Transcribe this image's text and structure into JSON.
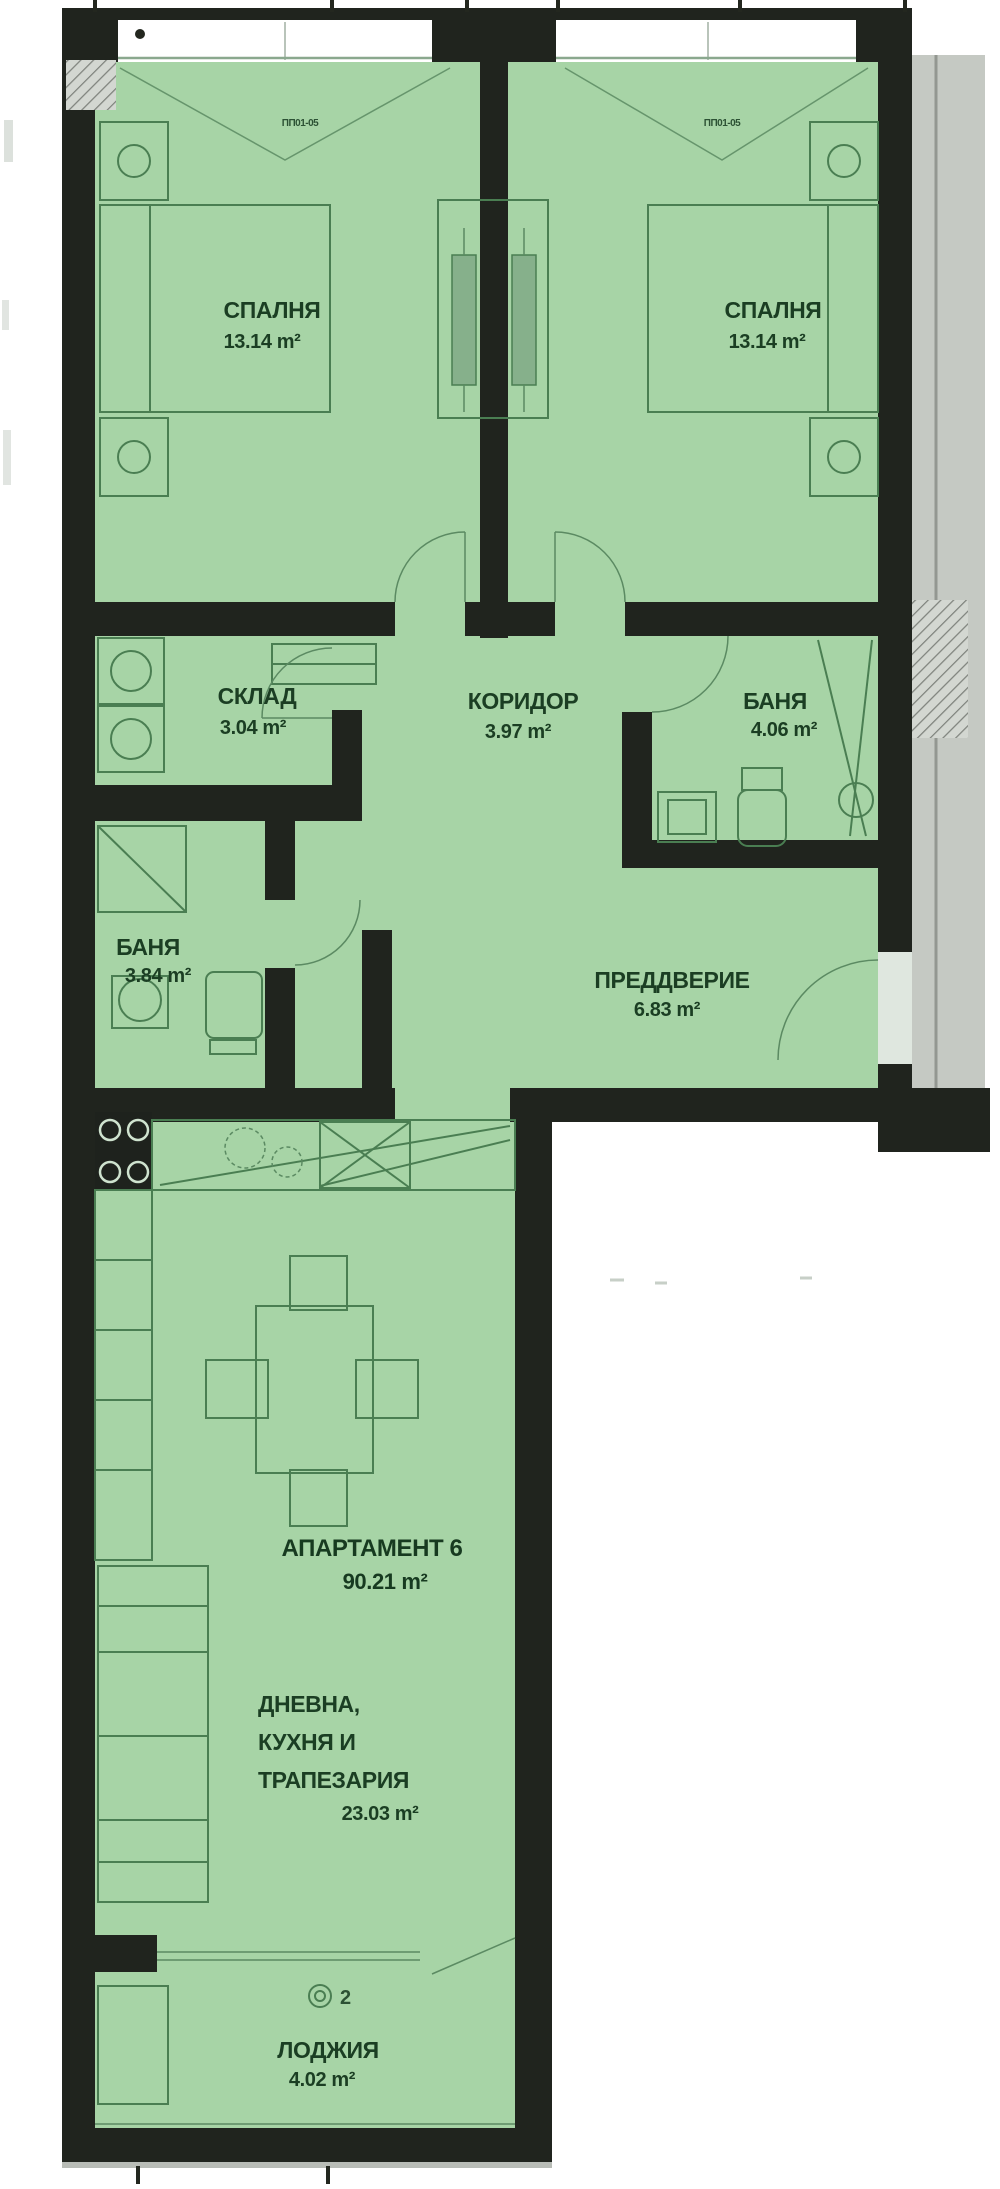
{
  "colors": {
    "room_fill": "#a7d4a6",
    "line_green": "#4a7e52",
    "text_green": "#1b3e23",
    "wall_dark": "#20241e",
    "gray_strip": "#c5c9c3",
    "white": "#ffffff"
  },
  "plan": {
    "rooms": {
      "bedroom_left": {
        "name": "СПАЛНЯ",
        "area": "13.14 m²"
      },
      "bedroom_right": {
        "name": "СПАЛНЯ",
        "area": "13.14 m²"
      },
      "storage": {
        "name": "СКЛАД",
        "area": "3.04 m²"
      },
      "corridor": {
        "name": "КОРИДОР",
        "area": "3.97 m²"
      },
      "bath_right": {
        "name": "БАНЯ",
        "area": "4.06 m²"
      },
      "bath_left": {
        "name": "БАНЯ",
        "area": "3.84 m²"
      },
      "vestibule": {
        "name": "ПРЕДДВЕРИЕ",
        "area": "6.83 m²"
      },
      "loggia": {
        "name": "ЛОДЖИЯ",
        "area": "4.02 m²"
      }
    },
    "apartment": {
      "title": "АПАРТАМЕНТ 6",
      "area": "90.21 m²"
    },
    "living": {
      "line1": "ДНЕВНА,",
      "line2": "КУХНЯ И",
      "line3": "ТРАПЕЗАРИЯ",
      "area": "23.03 m²"
    },
    "marks": {
      "window_tag_left": "ПП01-05",
      "window_tag_right": "ПП01-05",
      "loggia_number": "2"
    }
  }
}
